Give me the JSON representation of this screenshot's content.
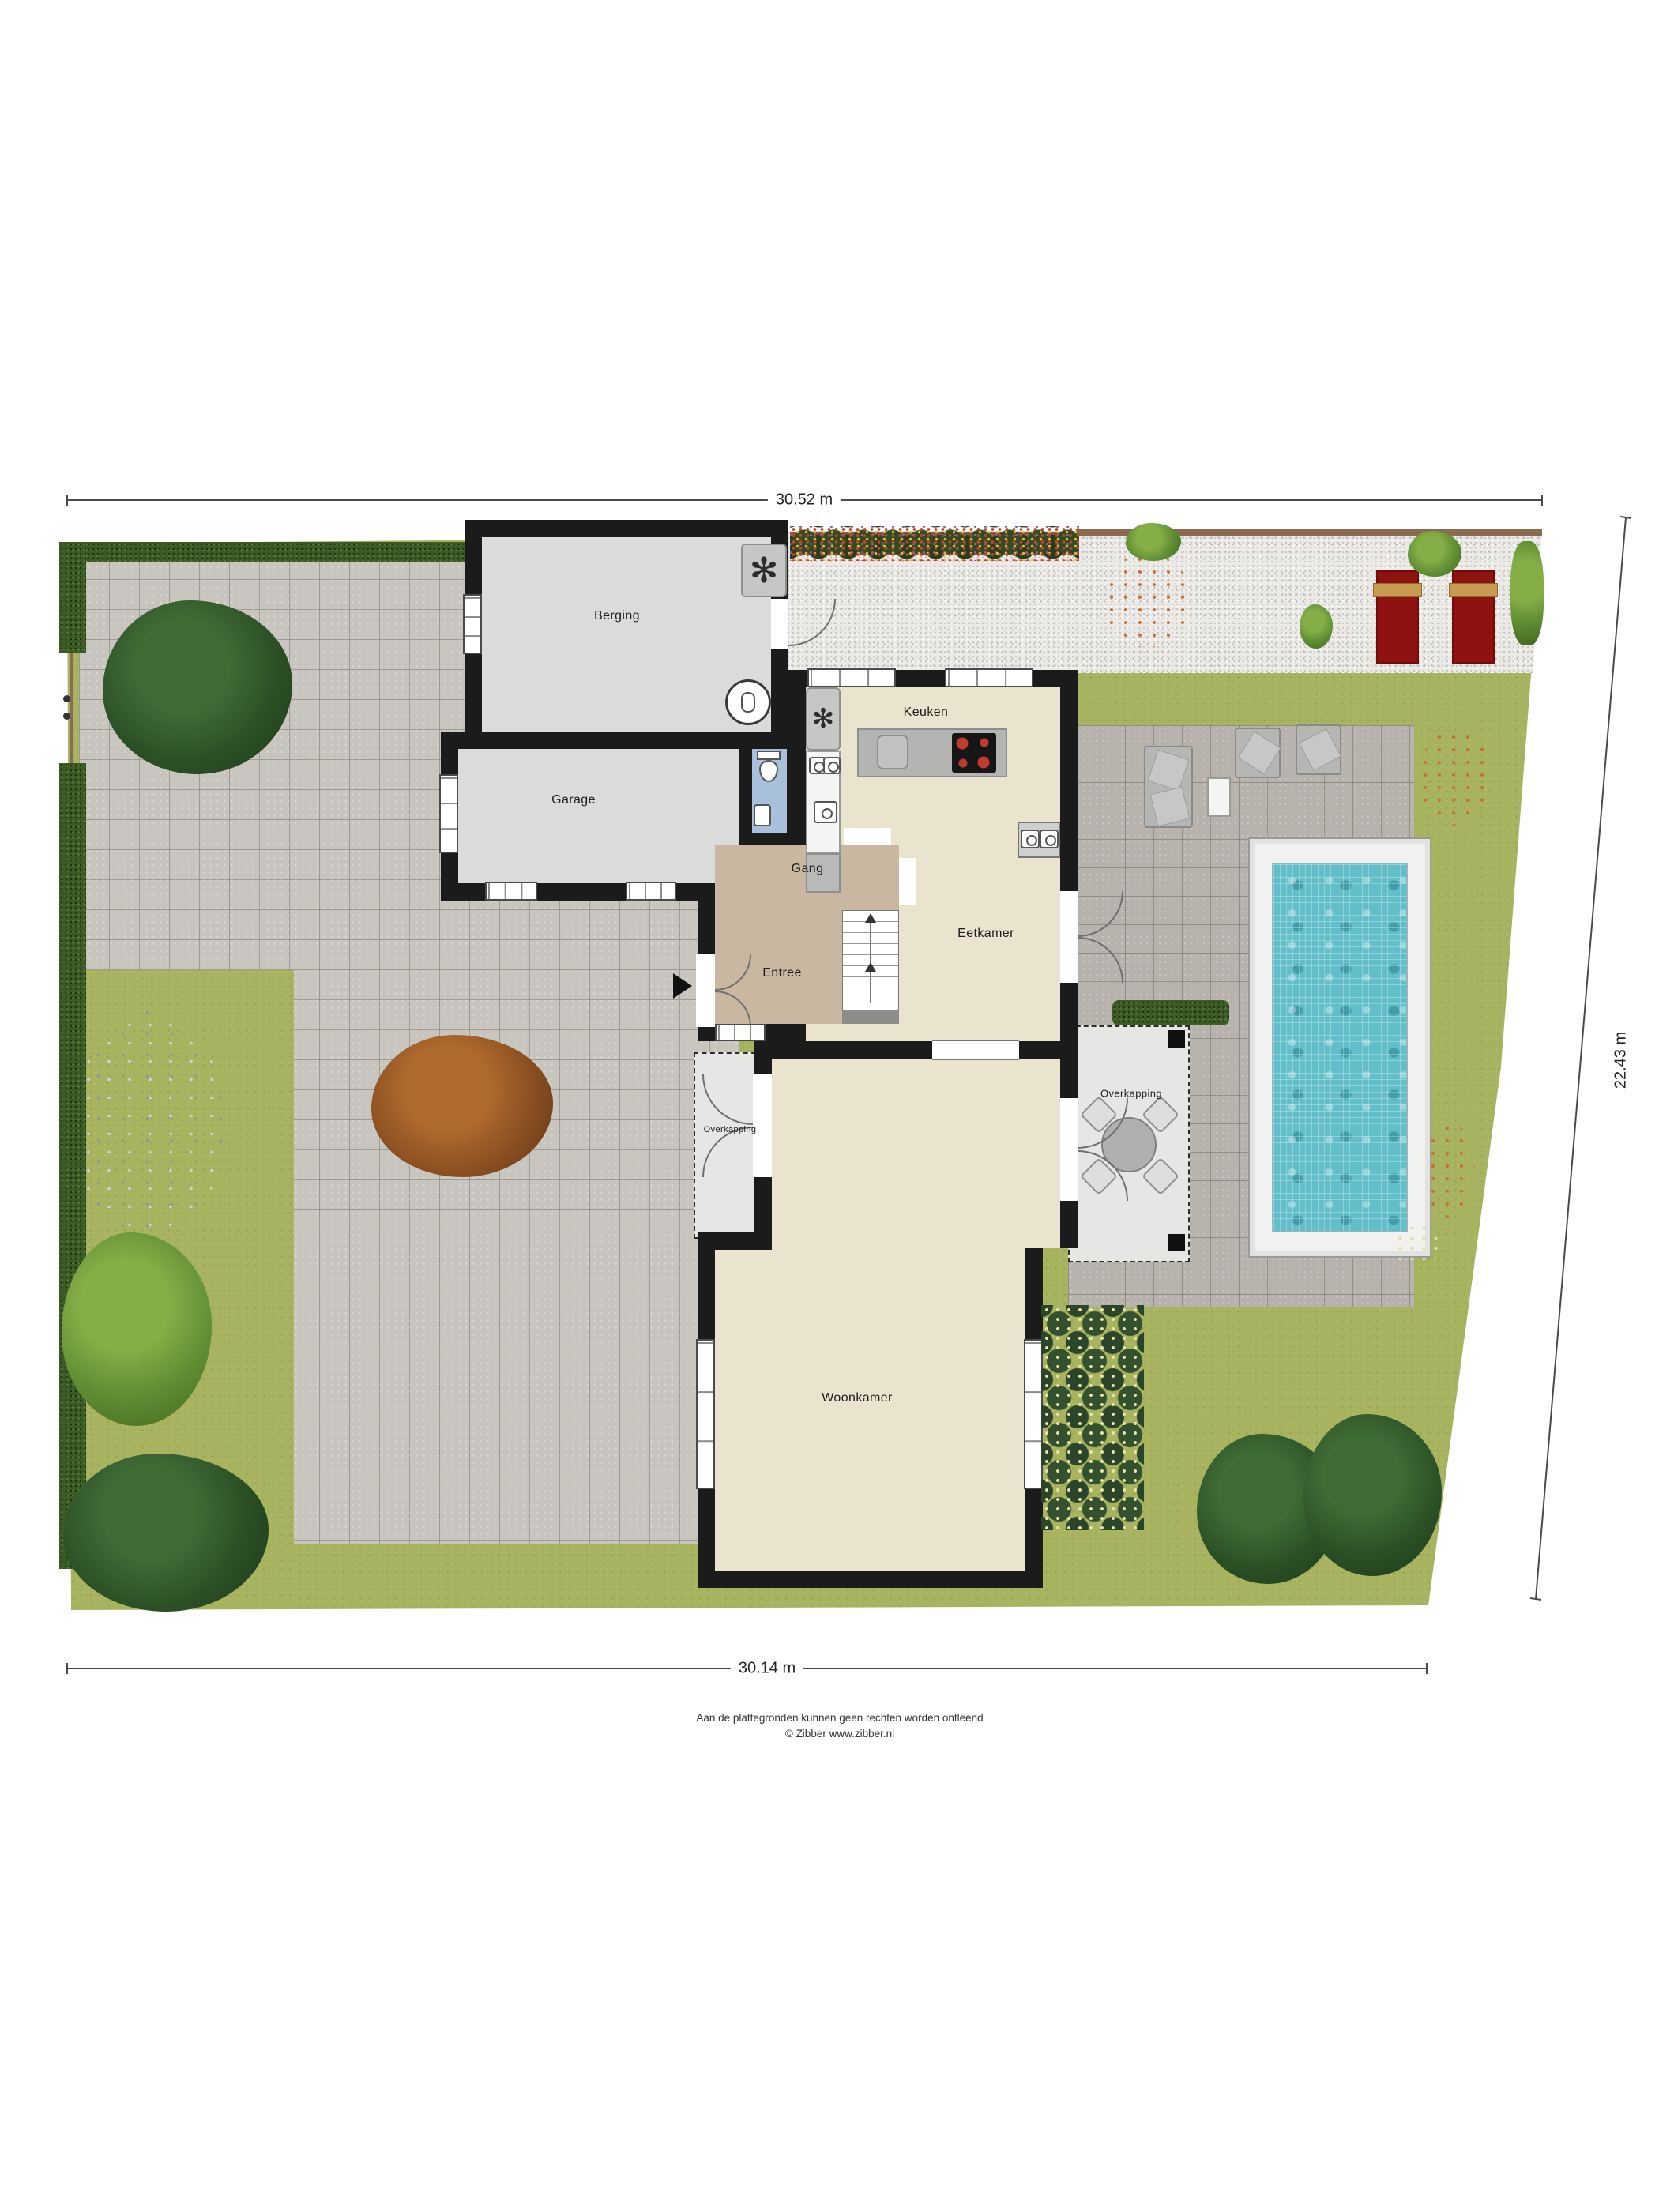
{
  "dimensions": {
    "top": "30.52 m",
    "right": "22.43 m",
    "bottom": "30.14 m"
  },
  "rooms": {
    "berging": "Berging",
    "garage": "Garage",
    "keuken": "Keuken",
    "gang": "Gang",
    "entree": "Entree",
    "eetkamer": "Eetkamer",
    "overkapping_left": "Overkapping",
    "overkapping_right": "Overkapping",
    "woonkamer": "Woonkamer"
  },
  "icons": {
    "fan": "✻"
  },
  "footer": {
    "disclaimer": "Aan de plattegronden kunnen geen rechten worden ontleend",
    "copyright": "© Zibber www.zibber.nl"
  },
  "colors": {
    "grass": "#a7b35f",
    "driveway": "#c8c5bf",
    "patio": "#b7b3ac",
    "gravel": "#eceae7",
    "wall": "#1b1b1b",
    "floor_cream": "#eae3cd",
    "floor_tan": "#c9b7a2",
    "floor_wc": "#a9c0dc",
    "pool_water": "#62bfc9",
    "lounger_red": "#8e1210"
  }
}
